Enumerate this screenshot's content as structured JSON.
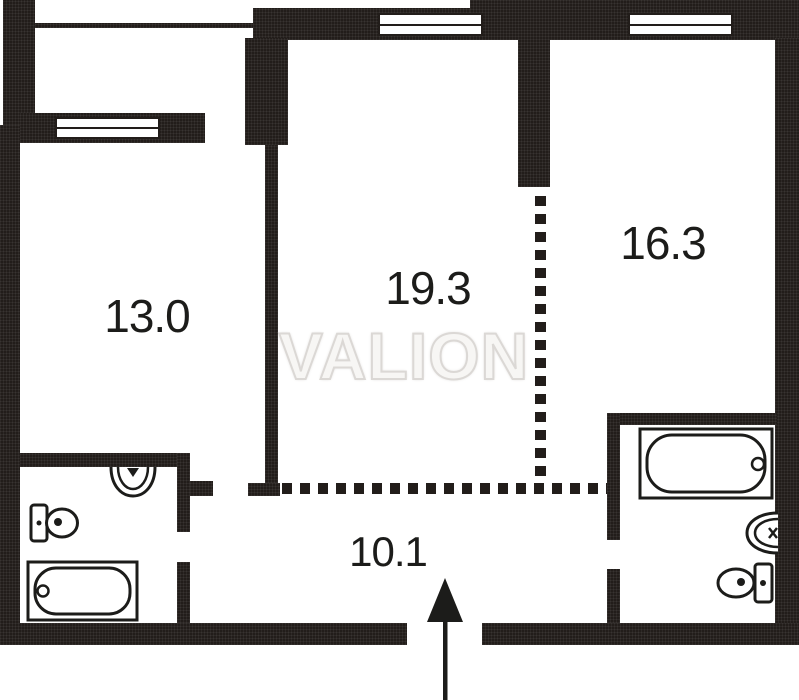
{
  "floor_plan": {
    "watermark": "VALION",
    "rooms": [
      {
        "id": "room-left",
        "area_label": "13.0"
      },
      {
        "id": "room-center",
        "area_label": "19.3"
      },
      {
        "id": "room-right",
        "area_label": "16.3"
      },
      {
        "id": "hallway",
        "area_label": "10.1"
      }
    ],
    "fixtures": [
      "bathtub-left",
      "toilet-left",
      "sink-left",
      "bathtub-right",
      "toilet-right",
      "sink-right"
    ],
    "entrance": {
      "direction": "up"
    },
    "colors": {
      "wall": "#221d1a",
      "background": "#ffffff",
      "fixture_outline": "#1c1c1a",
      "label_text": "#1c1c1a",
      "watermark_fill": "#f7f6f4",
      "watermark_halo": "#dbd8d5"
    }
  }
}
